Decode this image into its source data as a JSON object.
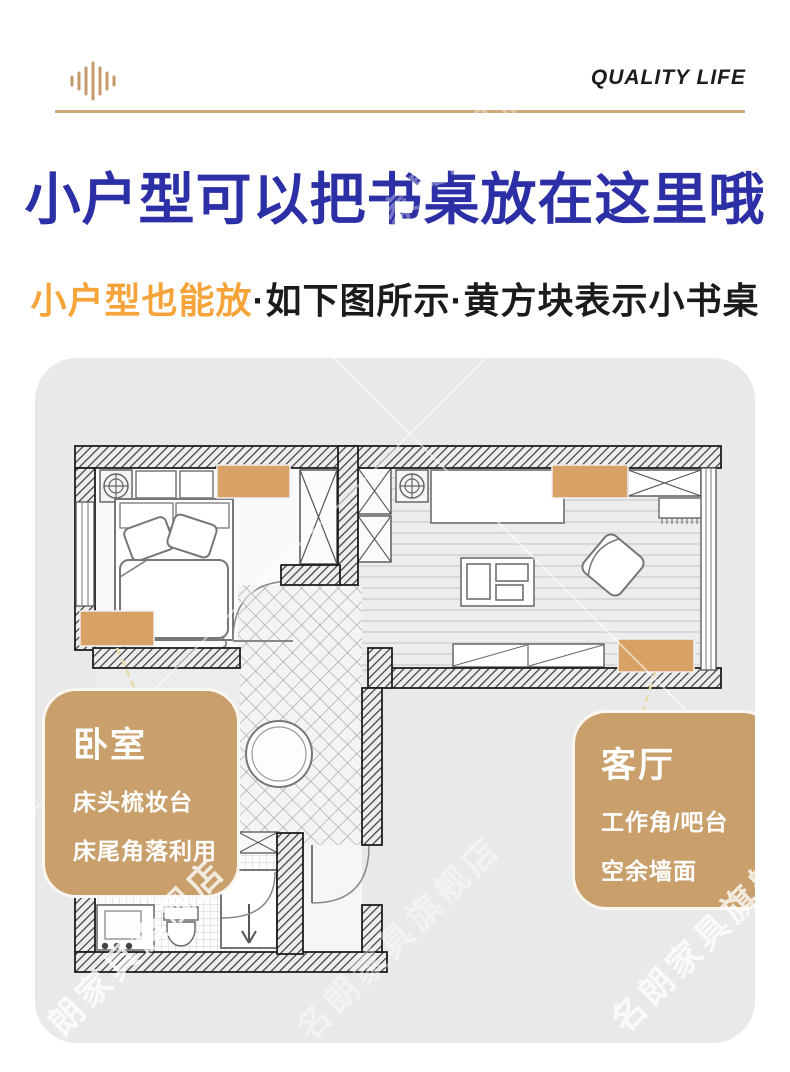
{
  "header": {
    "logo_icon": "sound-wave-icon",
    "brand": "QUALITY LIFE"
  },
  "title": "小户型可以把书桌放在这里哦",
  "subtitle": {
    "highlight": "小户型也能放",
    "rest": "·如下图所示·黄方块表示小书桌"
  },
  "floorplan": {
    "desk_marker_color": "#d7a263",
    "desk_marker_locations": [
      "bedroom-headboard-wall",
      "bedroom-foot-corner",
      "living-room-top-wall",
      "living-room-bottom-wall"
    ],
    "callouts": [
      {
        "title": "卧室",
        "lines": [
          "床头梳妆台",
          "床尾角落利用"
        ]
      },
      {
        "title": "客厅",
        "lines": [
          "工作角/吧台",
          "空余墙面"
        ]
      }
    ]
  },
  "watermark": {
    "text": "名朗家具旗舰店"
  },
  "colors": {
    "accent_gold": "#c9a06c",
    "desk_marker": "#d7a263",
    "title_blue": "#2c2fa5",
    "subtitle_orange": "#f6a43a",
    "divider_gold": "#d2a878",
    "card_background": "#e9e9ea"
  }
}
